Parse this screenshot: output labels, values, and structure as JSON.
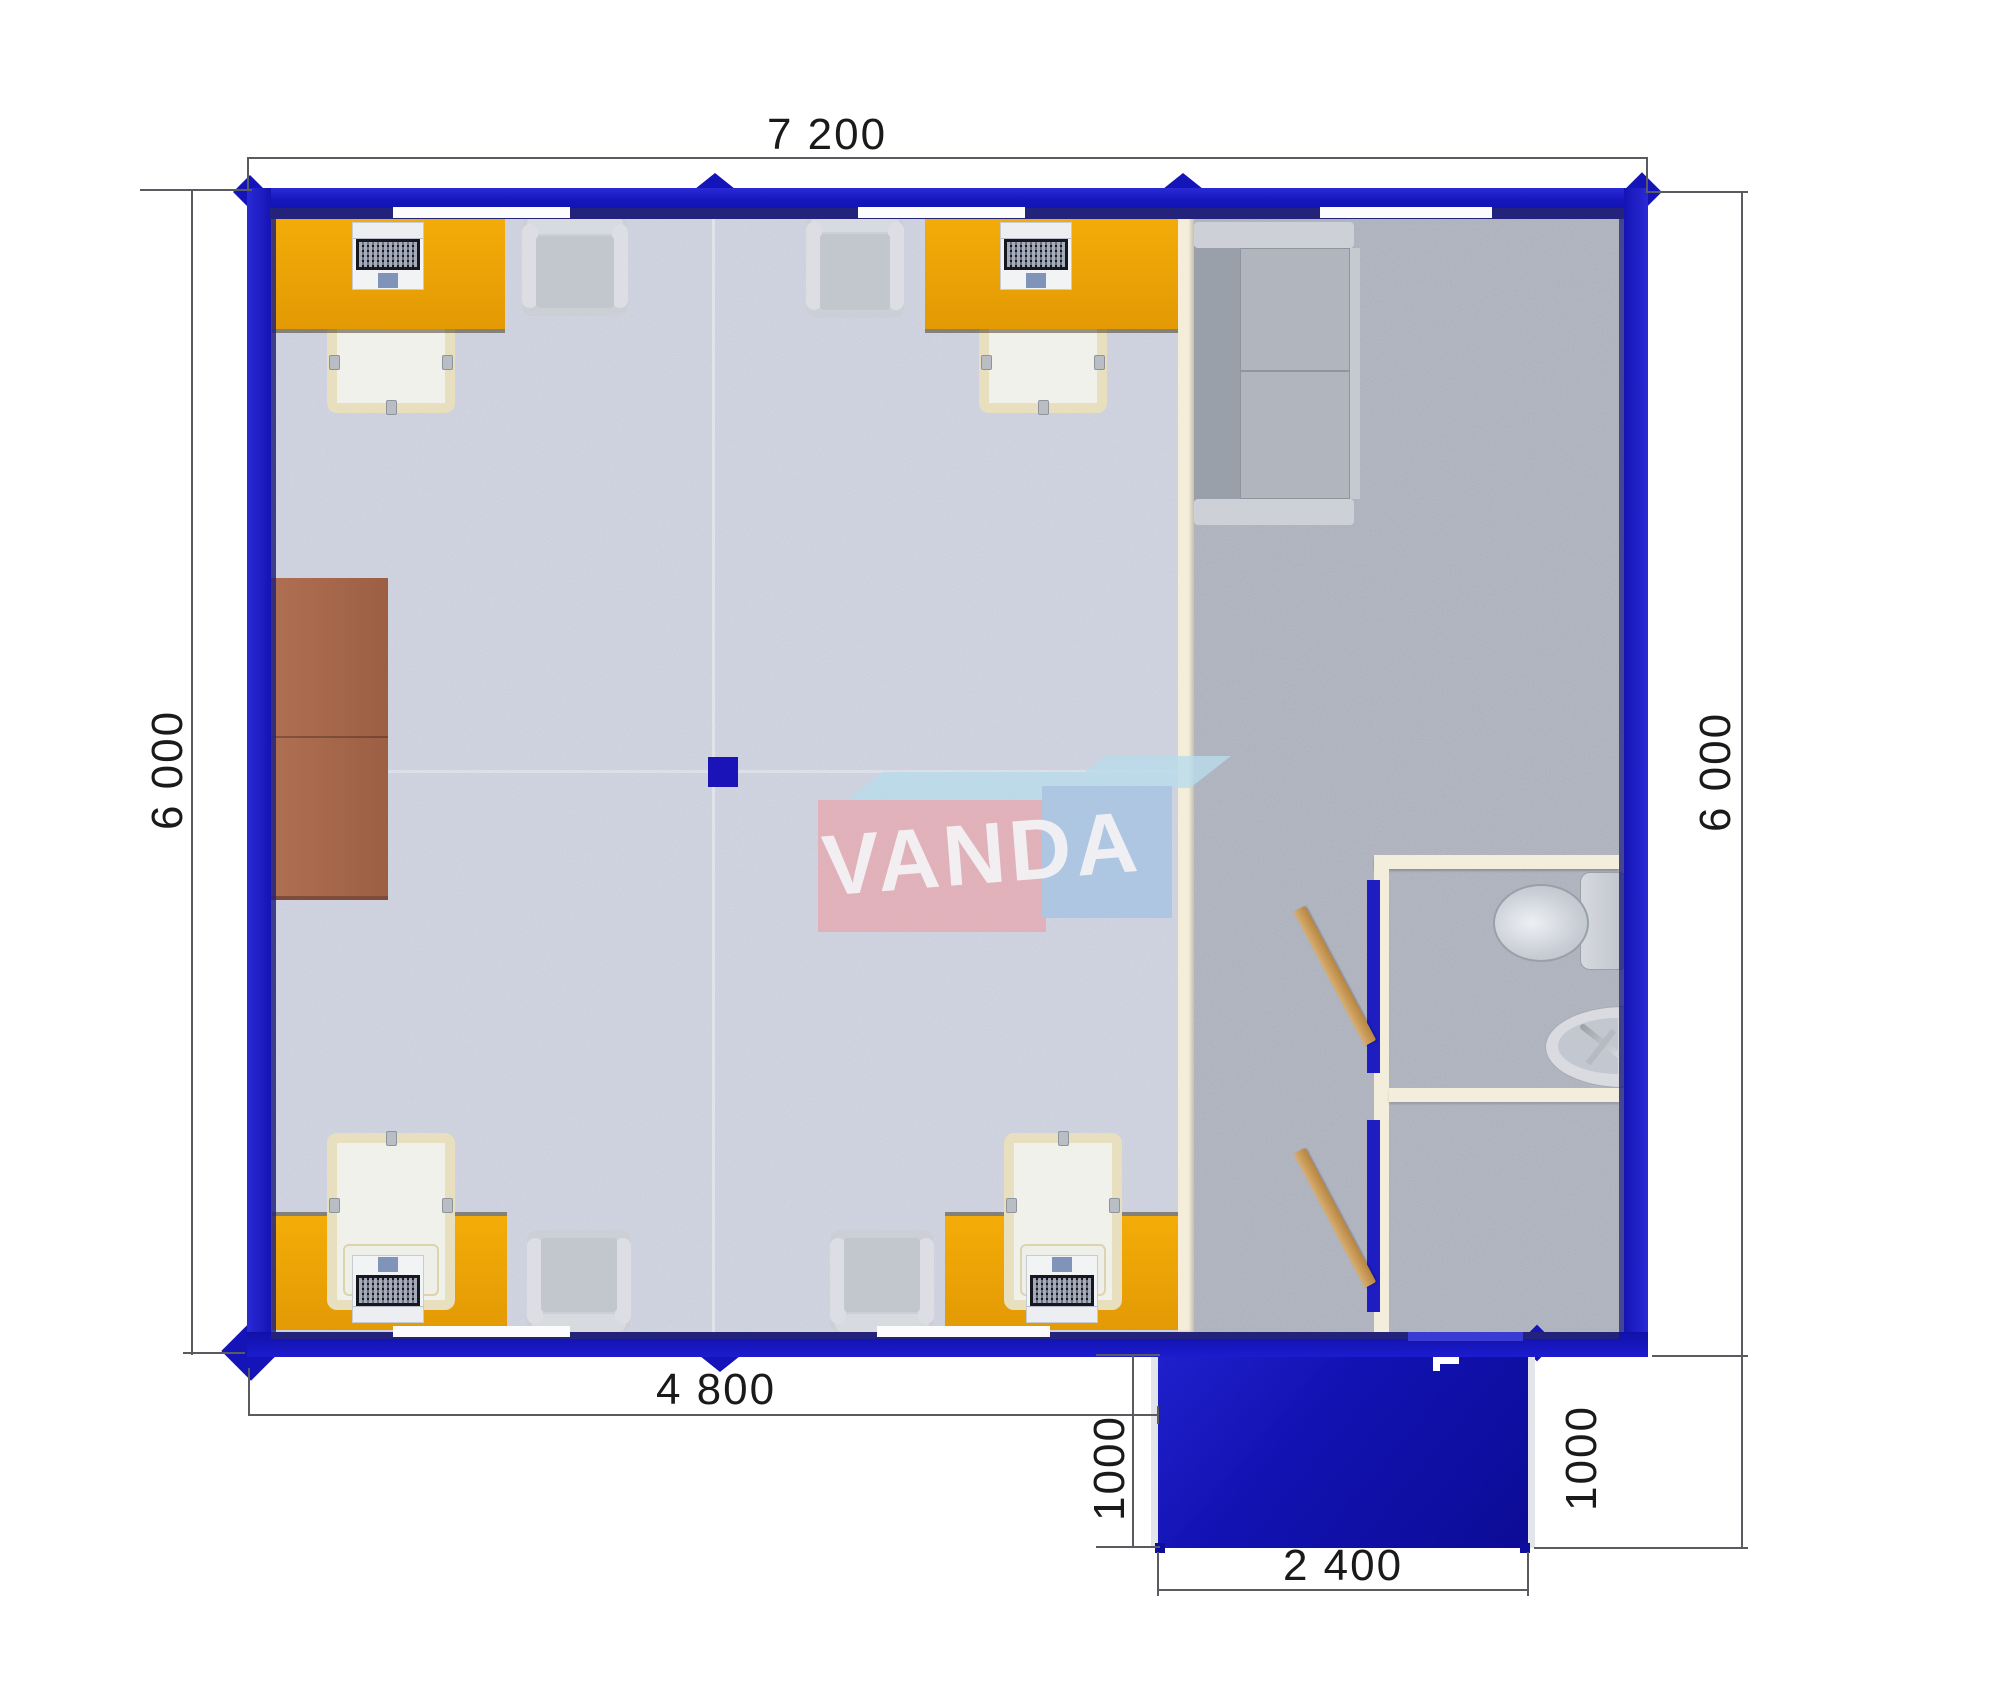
{
  "meta": {
    "title": "VANDA modular building floor plan",
    "view": "top-down architectural plan"
  },
  "watermark": {
    "text": "VANDA"
  },
  "dimensions": {
    "overall_width": "7 200",
    "office_depth_left": "6 000",
    "hall_depth_right": "6 000",
    "office_width": "4 800",
    "porch_depth_left": "1000",
    "porch_width": "2 400",
    "porch_depth_right": "1000"
  },
  "colors": {
    "wall_blue": "#1515bd",
    "wall_inner_navy": "#23237c",
    "desk_orange": "#eda206",
    "partition_cream": "#f3edda",
    "floor_office": "#d7dae5",
    "floor_hall": "#b9bdc7",
    "cabinet_brown": "#a8684e",
    "porch_blue": "#1212b2",
    "door_wood": "#c89a62",
    "logo_pink": "#e6aab2",
    "logo_blue": "#a6c4e2",
    "logo_sky": "#b9dcec"
  },
  "furniture": {
    "desks_with_laptops": 4,
    "task_chairs": 4,
    "armchairs": 4,
    "sofa": 1,
    "cabinet": 1,
    "toilet": 1,
    "sink": 1,
    "open_doors": 2
  }
}
